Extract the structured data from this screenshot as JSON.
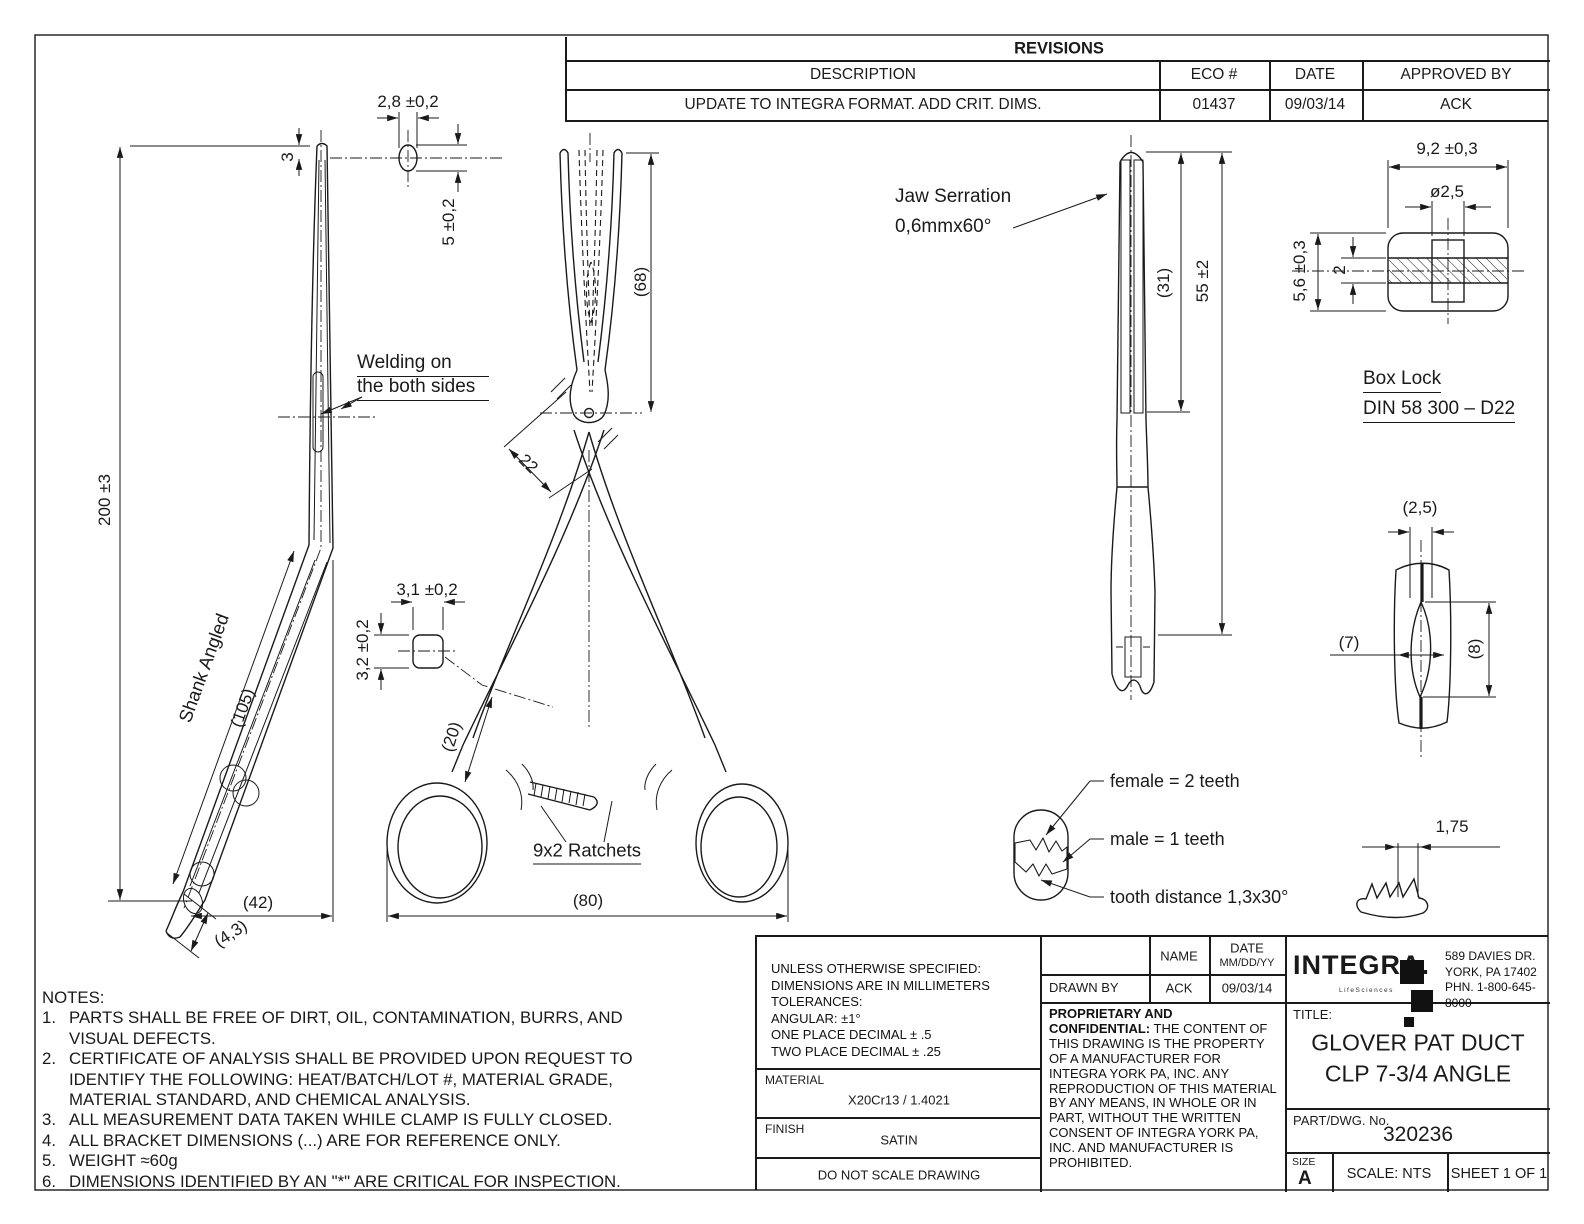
{
  "revisions": {
    "title": "REVISIONS",
    "col_description": "DESCRIPTION",
    "col_eco": "ECO #",
    "col_date": "DATE",
    "col_approved": "APPROVED BY",
    "row": {
      "description": "UPDATE TO INTEGRA FORMAT. ADD CRIT. DIMS.",
      "eco": "01437",
      "date": "09/03/14",
      "approved": "ACK"
    }
  },
  "side_view": {
    "dim_length": "200 ±3",
    "dim_tip_offset": "3",
    "dim_cs_width": "2,8 ±0,2",
    "dim_cs_height": "5 ±0,2",
    "welding_line1": "Welding on",
    "welding_line2": "the both sides",
    "shank_label": "Shank Angled",
    "shank_dim": "(105)",
    "dim_bend_offset": "(42)",
    "dim_tip_width": "(4,3)"
  },
  "front_view": {
    "dim_jaw_length": "(68)",
    "dim_boxlock": "22",
    "dim_cs_width": "3,1 ±0,2",
    "dim_cs_height": "3,2 ±0,2",
    "dim_handle": "(20)",
    "ratchets_label": "9x2 Ratchets",
    "dim_width": "(80)"
  },
  "jaw_view": {
    "serration_line1": "Jaw Serration",
    "serration_line2": "0,6mmx60°",
    "dim_serration_length": "(31)",
    "dim_jaw_length": "55 ±2"
  },
  "box_lock": {
    "dim_width": "9,2 ±0,3",
    "dim_hole": "ø2,5",
    "dim_height": "5,6 ±0,3",
    "dim_mid": "2",
    "label_line1": "Box Lock",
    "label_line2": "DIN  58 300 – D22"
  },
  "tip_view": {
    "dim_width_top": "(2,5)",
    "dim_width": "(7)",
    "dim_height": "(8)"
  },
  "teeth_detail": {
    "female": "female = 2 teeth",
    "male": "male = 1 teeth",
    "tooth_distance": "tooth distance 1,3x30°",
    "dim_pitch": "1,75"
  },
  "notes": {
    "title": "NOTES:",
    "items": [
      {
        "num": "1.",
        "text": "PARTS SHALL BE FREE OF DIRT, OIL, CONTAMINATION, BURRS, AND VISUAL DEFECTS."
      },
      {
        "num": "2.",
        "text": "CERTIFICATE OF ANALYSIS SHALL BE PROVIDED UPON REQUEST TO IDENTIFY THE FOLLOWING: HEAT/BATCH/LOT #, MATERIAL GRADE, MATERIAL STANDARD, AND CHEMICAL ANALYSIS."
      },
      {
        "num": "3.",
        "text": "ALL MEASUREMENT DATA TAKEN WHILE CLAMP IS FULLY CLOSED."
      },
      {
        "num": "4.",
        "text": "ALL BRACKET DIMENSIONS (...) ARE FOR REFERENCE ONLY."
      },
      {
        "num": "5.",
        "text": "WEIGHT ≈60g"
      },
      {
        "num": "6.",
        "text": "DIMENSIONS IDENTIFIED BY AN \"*\" ARE CRITICAL FOR INSPECTION."
      }
    ]
  },
  "title_block": {
    "tolerances": [
      "UNLESS OTHERWISE SPECIFIED:",
      "DIMENSIONS ARE IN MILLIMETERS",
      "TOLERANCES:",
      "ANGULAR: ±1°",
      "ONE PLACE DECIMAL ± .5",
      "TWO PLACE DECIMAL ± .25"
    ],
    "material_label": "MATERIAL",
    "material_value": "X20Cr13 / 1.4021",
    "finish_label": "FINISH",
    "finish_value": "SATIN",
    "do_not_scale": "DO NOT SCALE DRAWING",
    "name_header": "NAME",
    "date_header": "DATE",
    "date_sub": "MM/DD/YY",
    "drawn_by": "DRAWN BY",
    "drawn_name": "ACK",
    "drawn_date": "09/03/14",
    "proprietary_title": "PROPRIETARY AND CONFIDENTIAL:",
    "proprietary_body": "THE CONTENT OF THIS DRAWING IS THE PROPERTY OF A MANUFACTURER FOR INTEGRA YORK PA, INC. ANY REPRODUCTION OF THIS MATERIAL BY ANY MEANS, IN WHOLE OR IN PART, WITHOUT THE WRITTEN CONSENT OF INTEGRA YORK PA, INC. AND MANUFACTURER IS PROHIBITED.",
    "logo_text": "INTEGRA.",
    "logo_tagline": "LifeSciences",
    "address_line1": "589 DAVIES DR.",
    "address_line2": "YORK, PA 17402",
    "address_line3": "PHN. 1-800-645-8000",
    "title_label": "TITLE:",
    "title_line1": "GLOVER PAT DUCT",
    "title_line2": "CLP 7-3/4 ANGLE",
    "part_label": "PART/DWG. No.",
    "part_value": "320236",
    "size_label": "SIZE",
    "size_value": "A",
    "scale": "SCALE: NTS",
    "sheet": "SHEET 1 OF 1"
  }
}
